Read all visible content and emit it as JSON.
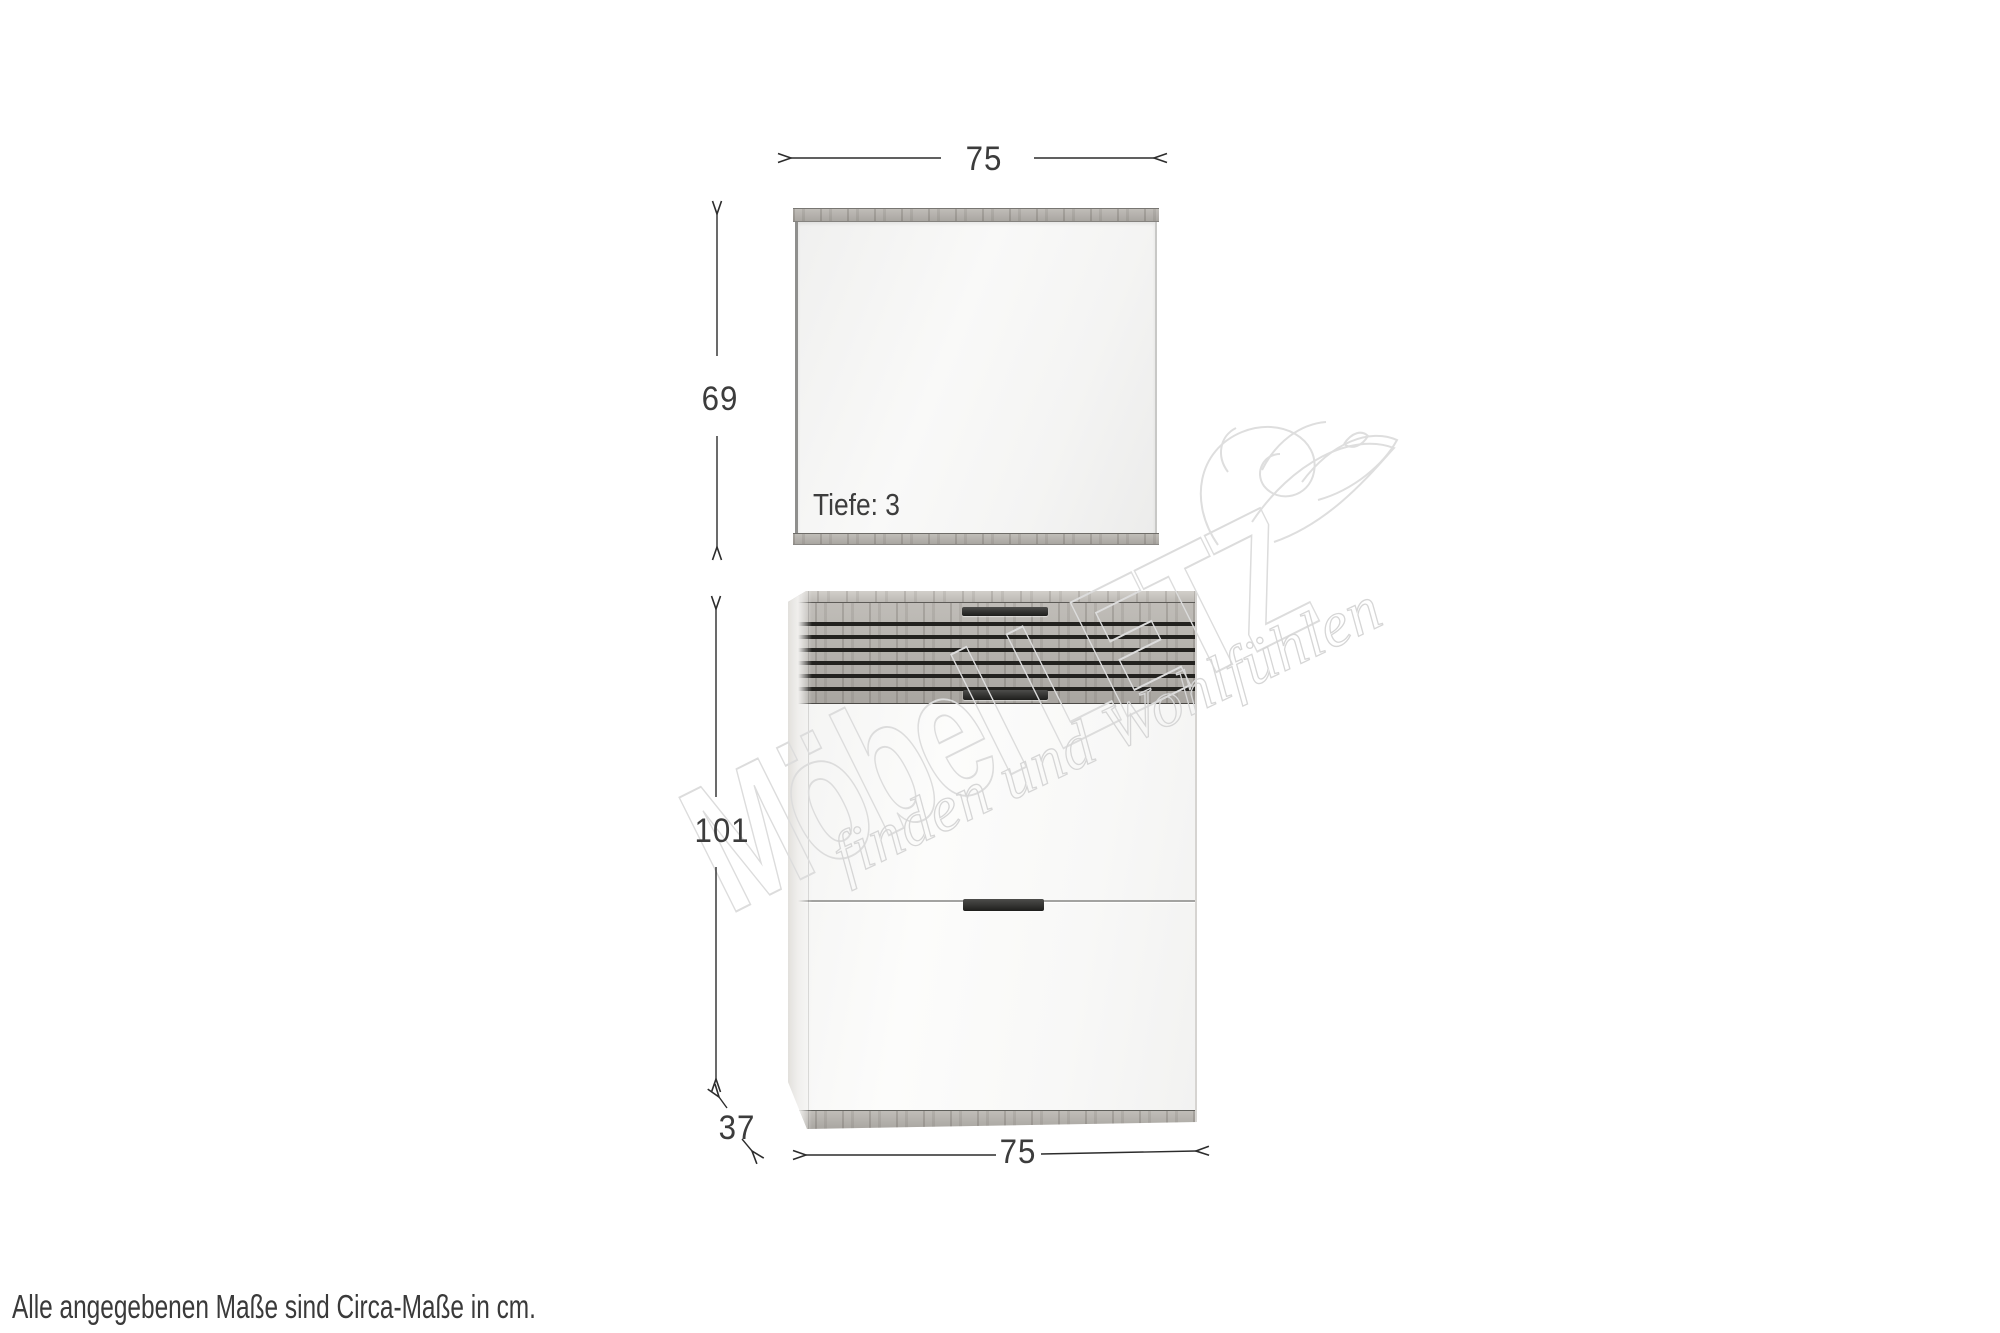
{
  "note": {
    "text": "Alle angegebenen Maße sind Circa-Maße in cm."
  },
  "watermark": {
    "brand": "Möbel LETZ",
    "slogan": "finden und Wohlfühlen"
  },
  "mirror": {
    "width_cm": "75",
    "height_cm": "69",
    "depth_label": "Tiefe: 3"
  },
  "cabinet": {
    "height_cm": "101",
    "depth_cm": "37",
    "width_cm": "75"
  }
}
